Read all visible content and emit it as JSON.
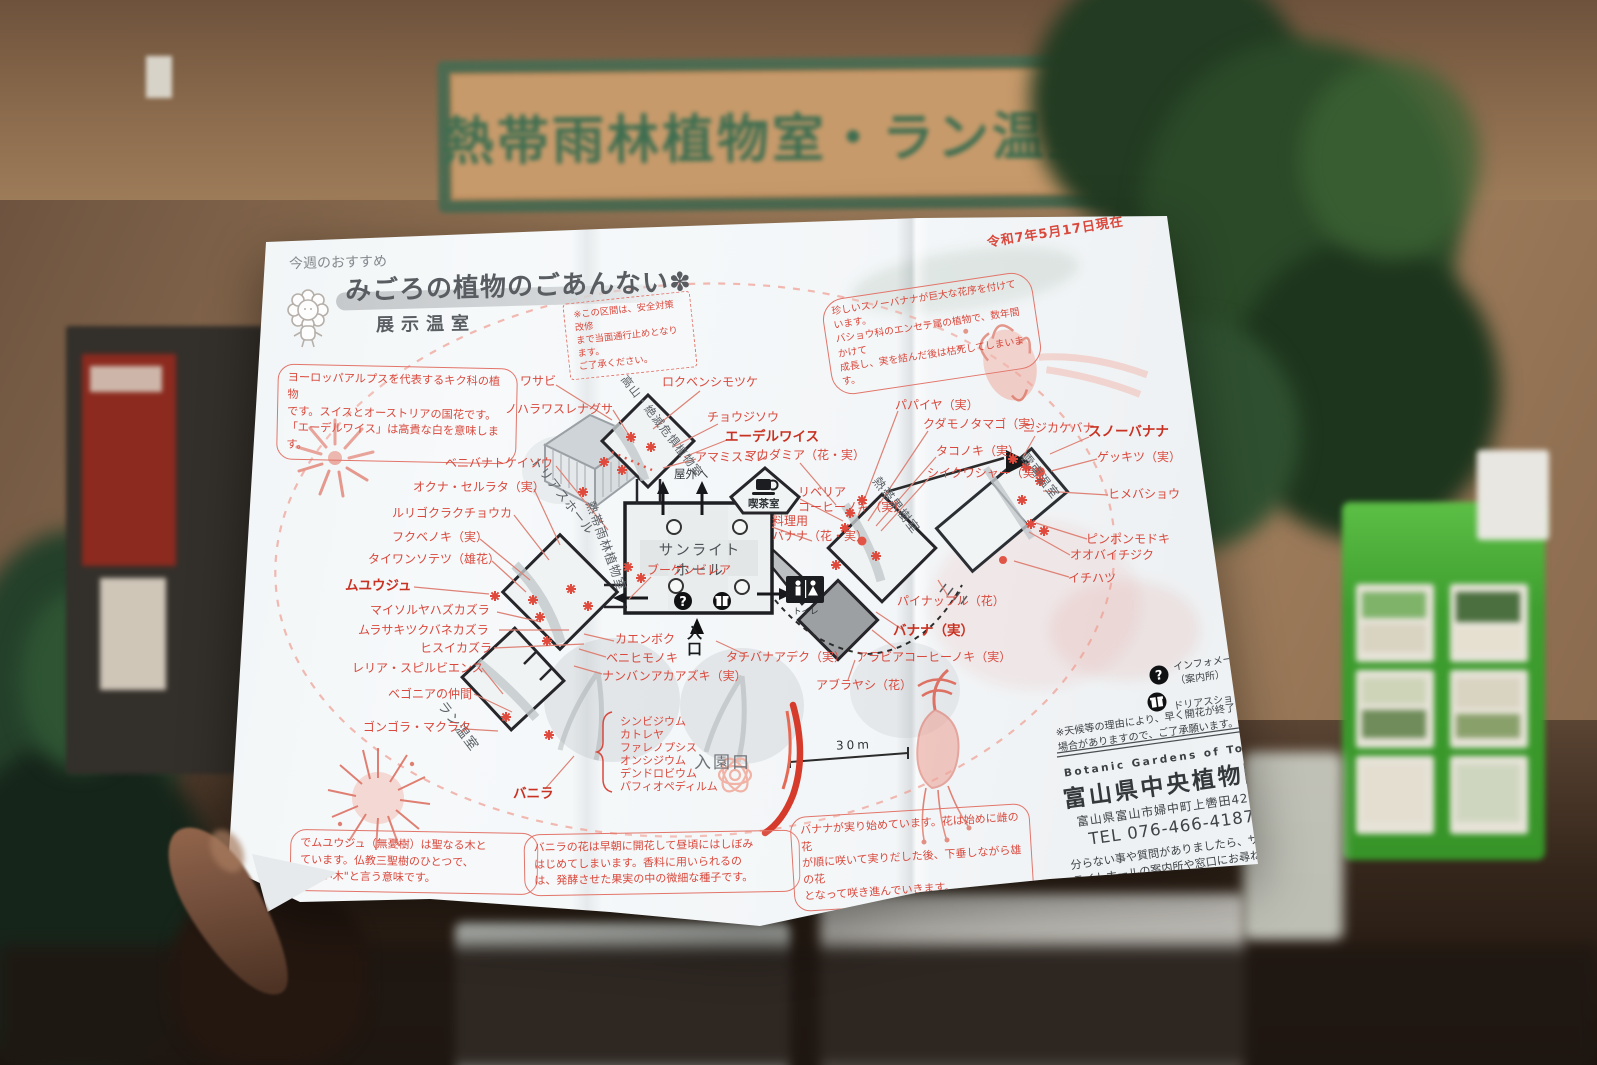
{
  "scene": {
    "wall_sign": "熱帯雨林植物室・ラン温室"
  },
  "pamphlet": {
    "header": {
      "eyebrow": "今週のおすすめ",
      "title": "みごろの植物のごあんない✽",
      "subtitle": "展示温室",
      "date_note": "令和7年5月17日現在"
    },
    "callouts": {
      "closure": "※この区間は、安全対策改修\nまで当面通行止めとなります。\nご了承ください。",
      "edelweiss": "ヨーロッパアルプスを代表するキク科の植物\nです。スイスとオーストリアの国花です。\n「エーデルワイス」は高貴な白を意味します。",
      "snow_banana": "珍しいスノーバナナが巨大な花序を付けています。\nバショウ科のエンセテ属の植物で、数年間かけて\n成長し、実を結んだ後は枯死してしまいます。",
      "muyuuju": "でムユウジュ（無憂樹）は聖なる木と\nています。仏教三聖樹のひとつで、\nのない木\"と言う意味です。",
      "vanilla": "バニラの花は早朝に開花して昼頃にはしぼみ\nはじめてしまいます。香料に用いられるの\nは、発酵させた果実の中の微細な種子です。",
      "banana": "バナナが実り始めています。花は始めに雌の花\nが順に咲いて実りだした後、下垂しながら雄の花\nとなって咲き進んでいきます。"
    },
    "rooms": {
      "triad_hall": "トリアスホール",
      "alpine": "高山・絶滅危惧植物室",
      "rainforest": "熱帯雨林植物室",
      "orchid_room": "ラン温室",
      "sunlight_hall": "サンライト\nホール",
      "cafe": "喫茶室",
      "fruit_room": "熱帯果樹室",
      "yunnan": "雲南温室"
    },
    "wayfinding": {
      "outdoor": "屋外へ",
      "entrance": "入口",
      "gate": "入園口",
      "toilet": "トイレ",
      "scale_label": "30m"
    },
    "plants": {
      "wasabi": "ワサビ",
      "noharawasurenagusa": "ノハラワスレナグサ",
      "benibanatokeisou": "ベニバナトケイソウ",
      "okuna_serrata": "オクナ・セルラタ（実）",
      "rurigokurakuchouka": "ルリゴクラクチョウカ",
      "fukubenoki": "フクベノキ（実）",
      "taiwansotetsu": "タイワンソテツ（雄花）",
      "muyuuju": "ムユウジュ",
      "mysore": "マイソルヤハズカズラ",
      "murasakitsukubane": "ムラサキツクバネカズラ",
      "hisuikazura": "ヒスイカズラ",
      "laelia": "レリア・スピルビエンス",
      "begonia": "ベゴニアの仲間",
      "gongora": "ゴンゴラ・マクラタ",
      "vanilla": "バニラ",
      "rokubenshimotsuke": "ロクベンシモツケ",
      "choujisou": "チョウジソウ",
      "edelweiss": "エーデルワイス",
      "amamisumire": "アマミスミレ",
      "macadamia": "マカダミア（花・実）",
      "liberia_coffee": "リベリア\nコーヒーノキ（実）",
      "cooking_banana": "料理用\nバナナ（花・実）",
      "bougainvillea": "ブーゲンビレア",
      "kaenboku": "カエンボク",
      "benihimonoki": "ベニヒモノキ",
      "nanban_akaazuki": "ナンバンアカアズキ（実）",
      "tachibana_adeku": "タチバナアデク（実）",
      "aburayashi": "アブラヤシ（花）",
      "pineapple": "パイナップル（花）",
      "banana_fruit": "バナナ（実）",
      "arabia_coffee": "アラビアコーヒーノキ（実）",
      "papaya": "パパイヤ（実）",
      "kudamonotamago": "クダモノタマゴ（実）",
      "takonoki": "タコノキ（実）",
      "shiikuwashaa": "シイクワシャー（実）",
      "nijikakebana": "ニジカケバナ",
      "snow_banana": "スノーバナナ",
      "gekkitsu": "ゲッキツ（実）",
      "himebashou": "ヒメバショウ",
      "pinponmodoki": "ピンポンモドキ",
      "oobaichijiku": "オオバイチジク",
      "ichihatsu": "イチハツ"
    },
    "orchids": [
      "シンビジウム",
      "カトレヤ",
      "ファレノプシス",
      "オンシジウム",
      "デンドロビウム",
      "パフィオペディルム"
    ],
    "legend": {
      "info": "インフォメーション\n（案内所）",
      "shop": "ドリアスショップ"
    },
    "notes": {
      "weather": "※天候等の理由により、早く開花が終了する\n場合がありますので、ご了承願います。",
      "question": "分らない事や質問がありましたら、サン\nライトホールの案内所や窓口にお尋ね\nください。"
    },
    "org": {
      "en": "Botanic Gardens of Toyama",
      "name": "富山県中央植物園",
      "address": "富山県富山市婦中町上轡田42",
      "tel": "TEL 076-466-4187"
    }
  }
}
